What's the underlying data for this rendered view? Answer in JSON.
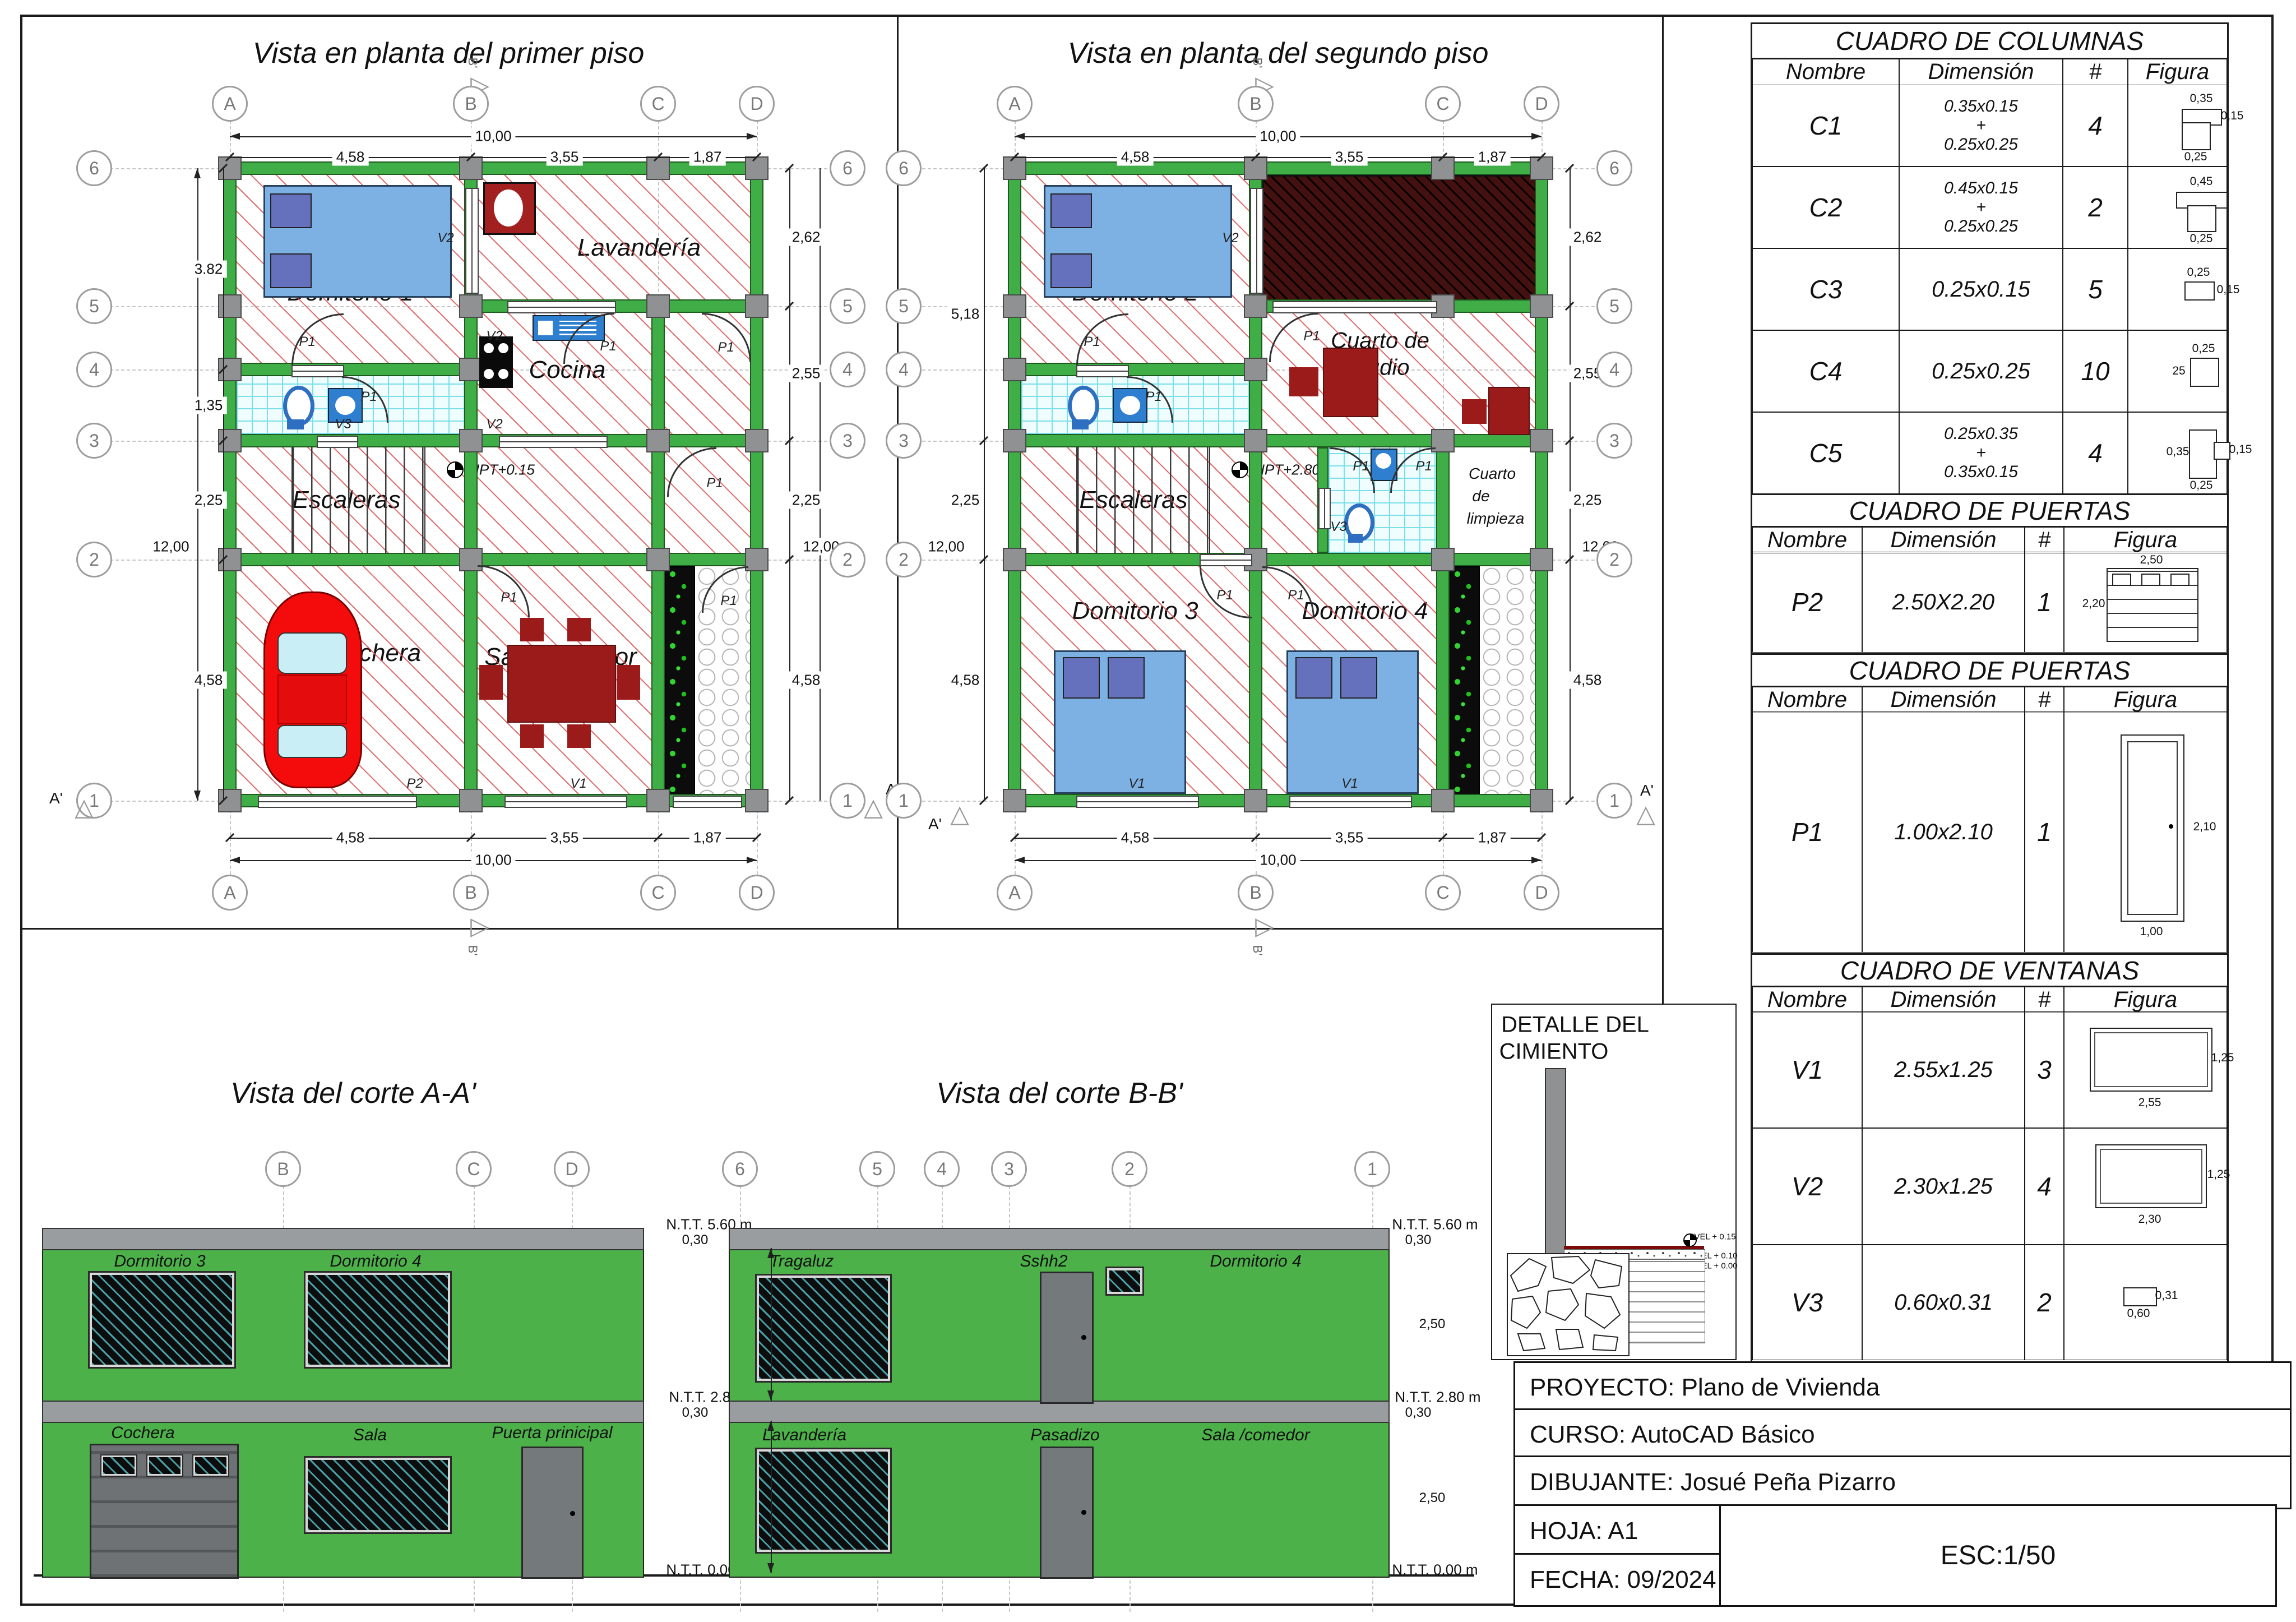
{
  "colors": {
    "wall_green": "#3fae47",
    "facade_green": "#4db14a",
    "column_grey": "#8f9193",
    "slab_grey": "#9a9da0",
    "hatch_red": "#d64e4e",
    "tile_cyan": "#79dfeb",
    "furniture_red": "#9b1b1b",
    "void_maroon": "#451010",
    "bed_blue": "#7db1e3",
    "pillow_blue": "#6671bd",
    "car_red": "#f40b0b",
    "door_grey": "#74797c",
    "plant_green": "#2fd42f"
  },
  "grid": {
    "cols": [
      "A",
      "B",
      "C",
      "D"
    ],
    "rows": [
      "6",
      "5",
      "4",
      "3",
      "2",
      "1"
    ]
  },
  "sym": {
    "p1": "P1",
    "p2": "P2",
    "v1": "V1",
    "v2": "V2",
    "v3": "V3",
    "aprime": "A'",
    "bprime": "B'",
    "tri": "△",
    "trir": "▷"
  },
  "dims": {
    "d10": "10,00",
    "d458": "4,58",
    "d355": "3,55",
    "d187": "1,87",
    "d382": "3.82",
    "d135": "1,35",
    "d12": "12,00",
    "d225": "2,25",
    "d262": "2,62",
    "d255": "2,55",
    "d518": "5,18"
  },
  "plan1": {
    "title": "Vista en planta del primer piso",
    "npt": "NPT+0.15",
    "rooms": {
      "dorm1": "Domitorio 1",
      "lav": "Lavandería",
      "cocina": "Cocina",
      "sshh1": "Sshh1",
      "esc": "Escaleras",
      "cochera": "Cochera",
      "sala": "Sala/comedor",
      "pas": "Pasadizo"
    }
  },
  "plan2": {
    "title": "Vista en planta del segundo piso",
    "npt": "NPT+2.80",
    "rooms": {
      "dorm2": "Domitorio 2",
      "est1": "Cuarto de",
      "est2": "estudio",
      "sshh1": "Sshh1",
      "esc": "Escaleras",
      "sshh2": "Sshh2",
      "limp1": "Cuarto",
      "limp2": "de",
      "limp3": "limpieza",
      "dorm3": "Domitorio 3",
      "dorm4": "Domitorio 4",
      "pas": "Pasadizo"
    }
  },
  "corteA": {
    "title": "Vista del corte A-A'",
    "rooms": {
      "dorm3": "Dormitorio 3",
      "dorm4": "Dormitorio 4",
      "cochera": "Cochera",
      "sala": "Sala",
      "puerta": "Puerta prinicipal"
    }
  },
  "corteB": {
    "title": "Vista del corte B-B'",
    "rooms": {
      "tragaluz": "Tragaluz",
      "sshh2": "Sshh2",
      "dorm4": "Dormitorio 4",
      "lav": "Lavandería",
      "pas": "Pasadizo",
      "sala": "Sala /comedor"
    }
  },
  "levels": {
    "ntt560": "N.T.T.  5.60 m",
    "ntt280": "N.T.T.  2.80 m",
    "ntt000": "N.T.T.  0.00 m",
    "d030": "0,30",
    "d250": "2,50"
  },
  "detalle": {
    "title1": "DETALLE DEL",
    "title2": "CIMIENTO",
    "n015": "NIVEL + 0.15",
    "n010": "NIVEL + 0.10",
    "n000": "NIVEL + 0.00"
  },
  "tables": {
    "headers": {
      "nombre": "Nombre",
      "dimension": "Dimensión",
      "num": "#",
      "figura": "Figura"
    },
    "columnas": {
      "title": "CUADRO DE COLUMNAS",
      "rows": [
        {
          "name": "C1",
          "d1": "0.35x0.15",
          "plus": "+",
          "d2": "0.25x0.25",
          "count": "4",
          "ft": "0,35",
          "fr": "0,15",
          "fb": "0,25"
        },
        {
          "name": "C2",
          "d1": "0.45x0.15",
          "plus": "+",
          "d2": "0.25x0.25",
          "count": "2",
          "ft": "0,45",
          "fb": "0,25"
        },
        {
          "name": "C3",
          "d1": "0.25x0.15",
          "plus": "",
          "d2": "",
          "count": "5",
          "ft": "0,25",
          "fr": "0,15"
        },
        {
          "name": "C4",
          "d1": "0.25x0.25",
          "plus": "",
          "d2": "",
          "count": "10",
          "ft": "0,25",
          "fl": "25"
        },
        {
          "name": "C5",
          "d1": "0.25x0.35",
          "plus": "+",
          "d2": "0.35x0.15",
          "count": "4",
          "fl": "0,35",
          "fr": "0,15",
          "fb": "0,25"
        }
      ]
    },
    "puertas1": {
      "title": "CUADRO DE PUERTAS",
      "row": {
        "name": "P2",
        "dim": "2.50X2.20",
        "count": "1",
        "ft": "2,50",
        "fl": "2,20"
      }
    },
    "puertas2": {
      "title": "CUADRO DE PUERTAS",
      "row": {
        "name": "P1",
        "dim": "1.00x2.10",
        "count": "1",
        "fr": "2,10",
        "fb": "1,00"
      }
    },
    "ventanas": {
      "title": "CUADRO DE VENTANAS",
      "rows": [
        {
          "name": "V1",
          "dim": "2.55x1.25",
          "count": "3",
          "fr": "1,25",
          "fb": "2,55"
        },
        {
          "name": "V2",
          "dim": "2.30x1.25",
          "count": "4",
          "fr": "1,25",
          "fb": "2,30"
        },
        {
          "name": "V3",
          "dim": "0.60x0.31",
          "count": "2",
          "fr": "0,31",
          "fb": "0,60"
        }
      ]
    }
  },
  "titleblock": {
    "proyecto": "PROYECTO: Plano de Vivienda",
    "curso": "CURSO: AutoCAD Básico",
    "dibujante": "DIBUJANTE: Josué Peña Pizarro",
    "hoja": "HOJA: A1",
    "fecha": "FECHA: 09/2024",
    "esc": "ESC:1/50"
  }
}
